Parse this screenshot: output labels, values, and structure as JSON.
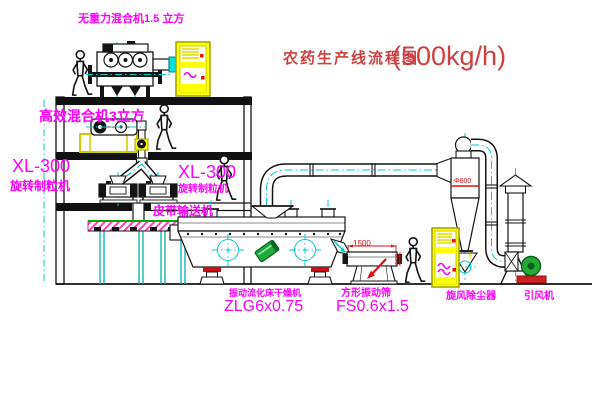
{
  "title": {
    "name": "农药生产线流程图",
    "capacity": "(500kg/h)"
  },
  "labels": {
    "mixer_top": "无重力混合机1.5 立方",
    "mixer_2f": "高效混合机3立方",
    "xl300_left_model": "XL-300",
    "xl300_left_name": "旋转制粒机",
    "xl300_mid_model": "XL-300",
    "xl300_mid_name": "旋转制粒机",
    "belt_conveyor": "皮带输送机",
    "dryer_name": "振动流化床干燥机",
    "dryer_model": "ZLG6x0.75",
    "screen_name": "方形振动筛",
    "screen_model": "FS0.6x1.5",
    "cyclone_name": "旋风除尘器",
    "fan_name": "引风机"
  },
  "dimensions": {
    "screen_length": "1500",
    "screen_height": "350",
    "cyclone_diameter": "Φ600"
  },
  "equipment_icons": [
    "gravity-free-mixer",
    "control-cabinet",
    "high-efficiency-mixer",
    "rotary-granulator",
    "belt-conveyor",
    "fluid-bed-dryer",
    "vibrating-screen",
    "cyclone-separator",
    "exhaust-stack",
    "induced-draft-fan",
    "worker-figure"
  ],
  "colors": {
    "label_magenta": "#ff00ff",
    "title_red": "#d04040",
    "dimension_red": "#dd1111",
    "centerline_cyan": "#00cccc",
    "cabinet_yellow": "#ffff00",
    "motor_green": "#22aa33",
    "support_red": "#cc2222",
    "belt_green": "#00aa00"
  }
}
